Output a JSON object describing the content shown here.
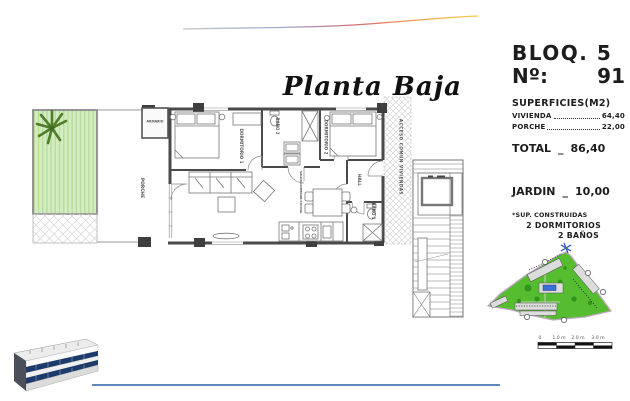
{
  "title": "Planta Baja",
  "panel": {
    "block_label": "BLOQ. 5",
    "number_label": "Nº:",
    "number_value": "91",
    "surfaces_header": "SUPERFICIES(M2)",
    "rows": [
      {
        "label": "VIVIENDA",
        "value": "64,40"
      },
      {
        "label": "PORCHE",
        "value": "22,00"
      }
    ],
    "total_label": "TOTAL",
    "total_sep": "_",
    "total_value": "86,40",
    "garden_label": "JARDIN",
    "garden_sep": "_",
    "garden_value": "10,00",
    "note": "*SUP. CONSTRUIDAS",
    "bedrooms": "2 DORMITORIOS",
    "bathrooms": "2 BAÑOS"
  },
  "floorplan": {
    "rooms": {
      "porch": "PORCHE",
      "closet": "ARMARIO",
      "bedroom1": "DORMITORIO 1",
      "bath2": "BAÑO 2",
      "bedroom2": "DORMITORIO 2",
      "hall": "HALL",
      "bath1": "BAÑO 1",
      "living": "SALON/COMEDOR/COCINA",
      "access": "ACCESO COMUN VIVIENDAS"
    }
  },
  "scalebar": {
    "labels": [
      "0",
      "1.0 m",
      "2.0 m",
      "3.0 m"
    ]
  },
  "colors": {
    "accent_blue": "#2d5da8",
    "site_green": "#55bd2f",
    "garden_green": "#d4ecc2",
    "wall_gray": "#4a4a4a"
  }
}
